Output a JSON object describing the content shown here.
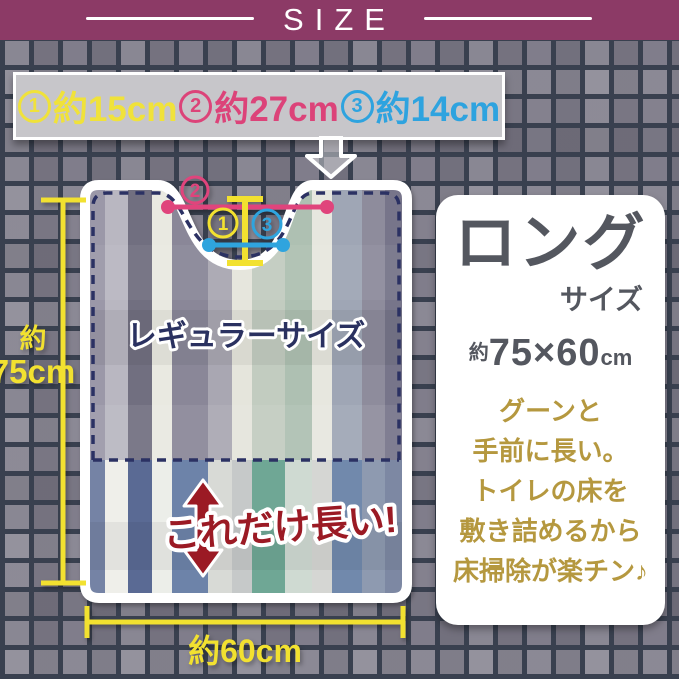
{
  "header": {
    "title": "SIZE",
    "bg_color": "#8C3A66"
  },
  "legend": {
    "items": [
      {
        "num": "1",
        "label": "約15cm",
        "color": "#F0E23A"
      },
      {
        "num": "2",
        "label": "約27cm",
        "color": "#DC4379"
      },
      {
        "num": "3",
        "label": "約14cm",
        "color": "#2EA3DF"
      }
    ]
  },
  "mat": {
    "regular_label": "レギュラーサイズ",
    "long_label": "これだけ長い!",
    "markers": {
      "m1": "1",
      "m2": "2",
      "m3": "3"
    },
    "measure_height": {
      "prefix": "約",
      "value": "75cm"
    },
    "measure_width": {
      "label": "約60cm"
    },
    "stripes": {
      "widths": [
        20,
        23,
        24,
        20,
        36,
        24,
        20,
        33,
        27,
        20,
        30,
        23,
        22
      ],
      "top_colors": [
        "#9b98a8",
        "#b9b7c1",
        "#716f80",
        "#e9e9e1",
        "#8a8798",
        "#a9a7b2",
        "#e5e5dc",
        "#c2ccc0",
        "#aec0b2",
        "#e7e7df",
        "#9fa6b5",
        "#8e8c9c",
        "#77758a"
      ],
      "bottom_colors": [
        "#7583a5",
        "#efefea",
        "#5a6a94",
        "#eceee9",
        "#6d83a9",
        "#d8dad6",
        "#c6c9c9",
        "#6fa795",
        "#cfdad2",
        "#d5d6d3",
        "#7189ac",
        "#8e9ab0",
        "#7d88a3"
      ]
    }
  },
  "panel": {
    "title": "ロング",
    "subtitle": "サイズ",
    "size": {
      "prefix": "約",
      "value": "75×60",
      "unit": "cm"
    },
    "description_lines": [
      "グーンと",
      "手前に長い。",
      "トイレの床を",
      "敷き詰めるから",
      "床掃除が楽チン♪"
    ],
    "text_color": "#54575F",
    "accent_color": "#B5983F"
  },
  "colors": {
    "tile": "#7B7886",
    "grout": "#39404F",
    "banner_bg": "#C7C6CA",
    "accent_yellow": "#F2E130",
    "accent_pink": "#E0447C",
    "accent_blue": "#2FA4DE",
    "dash_navy": "#2B3163",
    "warn_red": "#9B1A24"
  }
}
